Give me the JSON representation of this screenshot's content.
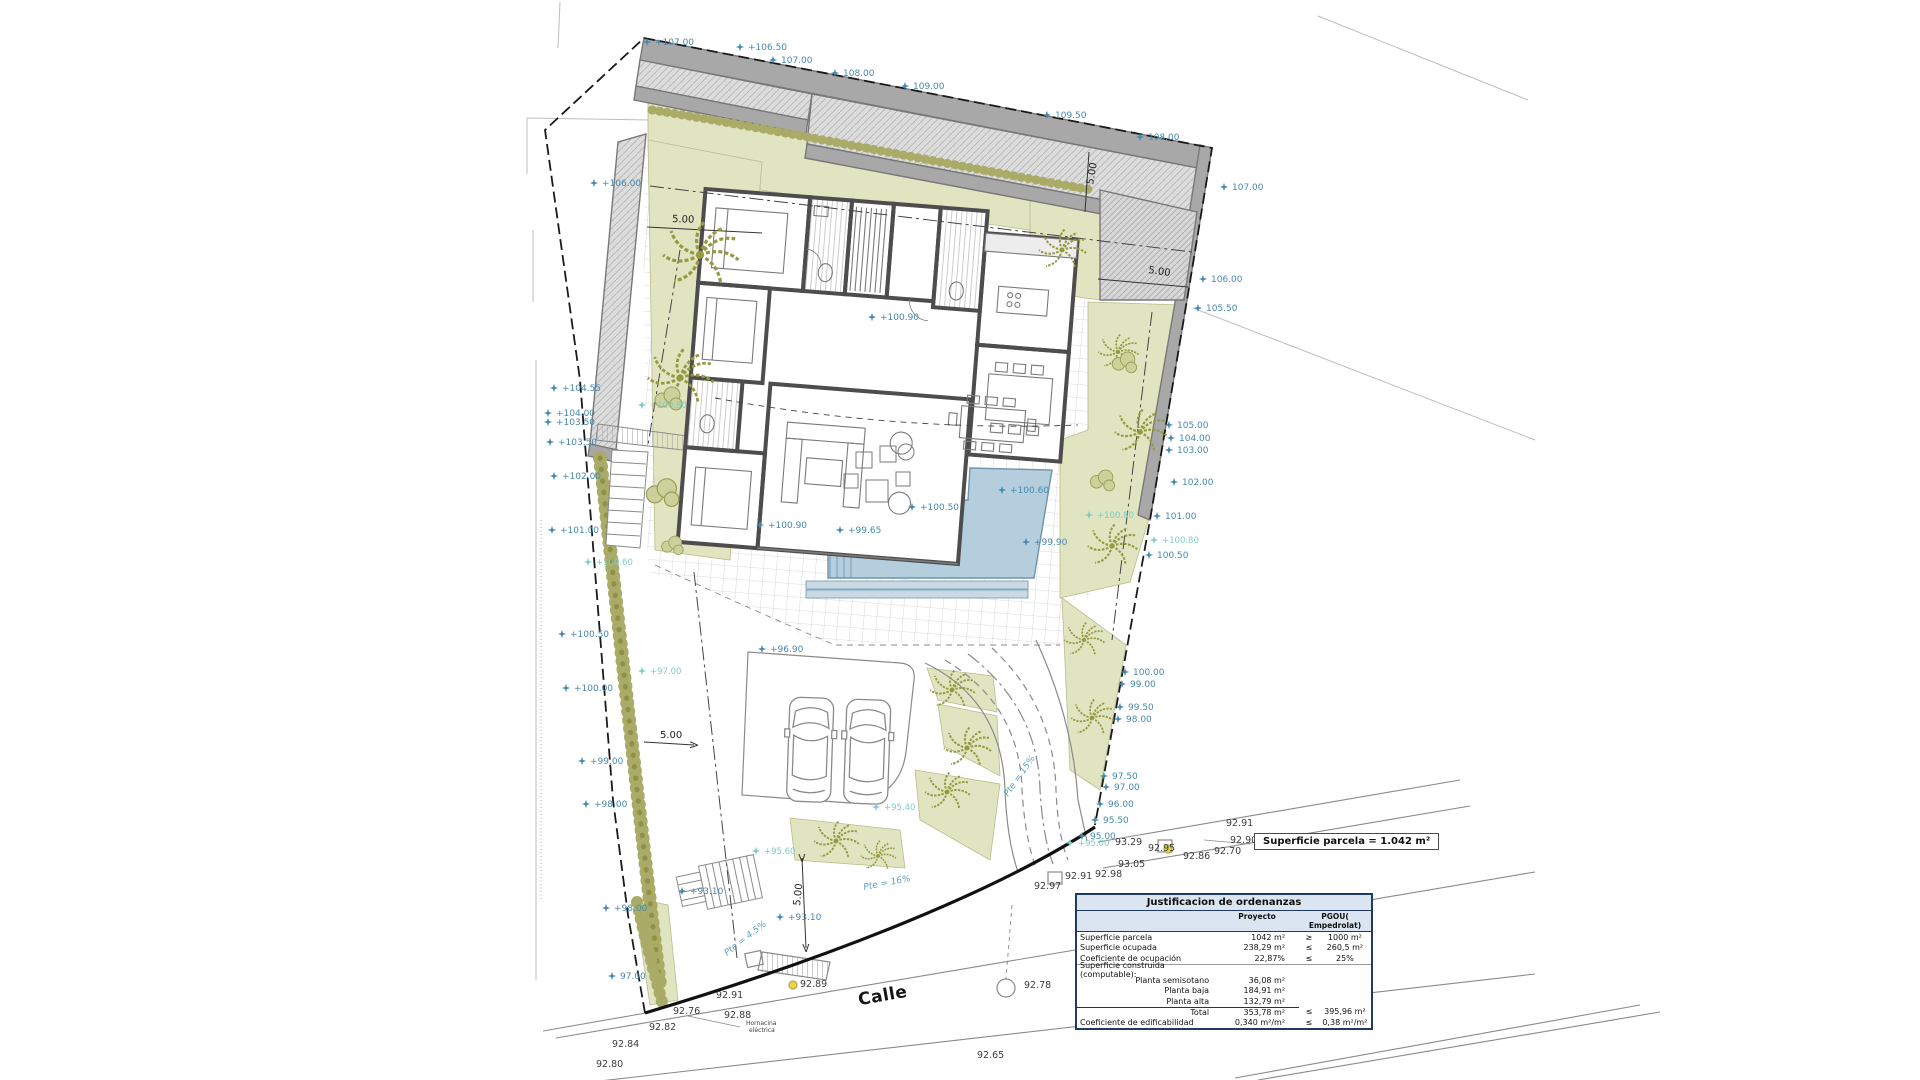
{
  "street": {
    "name": "Calle"
  },
  "parcel_box": {
    "text": "Superficie parcela = 1.042 m²"
  },
  "table": {
    "title": "Justificacion de ordenanzas",
    "col_proyecto": "Proyecto",
    "col_pgou": "PGOU( Empedrolat)",
    "rows": [
      {
        "label": "Superficie parcela",
        "proyecto": "1042 m²",
        "op": "≥",
        "pgou": "1000 m²",
        "style": "main"
      },
      {
        "label": "Superficie ocupada",
        "proyecto": "238,29 m²",
        "op": "≤",
        "pgou": "260,5 m²",
        "style": "main"
      },
      {
        "label": "Coeficiente de ocupación",
        "proyecto": "22,87%",
        "op": "≤",
        "pgou": "25%",
        "style": "main divider"
      },
      {
        "label": "Superficie construida (computable):",
        "proyecto": "",
        "op": "",
        "pgou": "",
        "style": "main"
      },
      {
        "label": "Planta semisotano",
        "proyecto": "36,08 m²",
        "op": "",
        "pgou": "",
        "style": "sub"
      },
      {
        "label": "Planta baja",
        "proyecto": "184,91 m²",
        "op": "",
        "pgou": "",
        "style": "sub"
      },
      {
        "label": "Planta alta",
        "proyecto": "132,79 m²",
        "op": "",
        "pgou": "",
        "style": "sub"
      },
      {
        "label": "Total",
        "proyecto": "353,78 m²",
        "op": "≤",
        "pgou": "395,96 m²",
        "style": "sub totalrow"
      },
      {
        "label": "Coeficiente de edificabilidad",
        "proyecto": "0,340 m²/m²",
        "op": "≤",
        "pgou": "0,38 m²/m²",
        "style": "main"
      }
    ]
  },
  "dims": [
    [
      672,
      222,
      "5.00",
      2
    ],
    [
      1148,
      273,
      "5.00",
      8
    ],
    [
      1093,
      185,
      "5.00",
      -80
    ],
    [
      660,
      738,
      "5.00",
      0
    ],
    [
      800,
      906,
      "5.00",
      -84
    ]
  ],
  "slopes": [
    [
      1008,
      797,
      "Pte = 15%",
      -55
    ],
    [
      864,
      890,
      "Pte = 16%",
      -11
    ],
    [
      727,
      956,
      "Pte = 4.5%",
      -38
    ]
  ],
  "levels_blue": [
    [
      655,
      45,
      "+107.00"
    ],
    [
      748,
      50,
      "+106.50"
    ],
    [
      781,
      63,
      "107.00"
    ],
    [
      843,
      76,
      "108.00"
    ],
    [
      913,
      89,
      "109.00"
    ],
    [
      1055,
      118,
      "109.50"
    ],
    [
      1148,
      140,
      "108.00"
    ],
    [
      1232,
      190,
      "107.00"
    ],
    [
      1211,
      282,
      "106.00"
    ],
    [
      1206,
      311,
      "105.50"
    ],
    [
      1177,
      428,
      "105.00"
    ],
    [
      1179,
      441,
      "104.00"
    ],
    [
      1177,
      453,
      "103.00"
    ],
    [
      1182,
      485,
      "102.00"
    ],
    [
      1165,
      519,
      "101.00"
    ],
    [
      1157,
      558,
      "100.50"
    ],
    [
      1133,
      675,
      "100.00"
    ],
    [
      1130,
      687,
      "99.00"
    ],
    [
      1128,
      710,
      "99.50"
    ],
    [
      1126,
      722,
      "98.00"
    ],
    [
      1112,
      779,
      "97.50"
    ],
    [
      1114,
      790,
      "97.00"
    ],
    [
      1108,
      807,
      "96.00"
    ],
    [
      1103,
      823,
      "95.50"
    ],
    [
      1090,
      839,
      "95.00"
    ],
    [
      562,
      391,
      "+104.55"
    ],
    [
      556,
      416,
      "+104.00"
    ],
    [
      556,
      425,
      "+103.50"
    ],
    [
      558,
      445,
      "+103.50"
    ],
    [
      562,
      479,
      "+102.00"
    ],
    [
      560,
      533,
      "+101.00"
    ],
    [
      570,
      637,
      "+100.50"
    ],
    [
      574,
      691,
      "+100.00"
    ],
    [
      590,
      764,
      "+99.00"
    ],
    [
      594,
      807,
      "+98.00"
    ],
    [
      614,
      911,
      "+98.00"
    ],
    [
      620,
      979,
      "97.00"
    ],
    [
      602,
      186,
      "+106.00"
    ],
    [
      1010,
      493,
      "+100.60"
    ],
    [
      920,
      510,
      "+100.50"
    ],
    [
      848,
      533,
      "+99.65"
    ],
    [
      1034,
      545,
      "+99.90"
    ],
    [
      880,
      320,
      "+100.90"
    ],
    [
      768,
      528,
      "+100.90"
    ],
    [
      770,
      652,
      "+96.90"
    ],
    [
      690,
      894,
      "+93.10"
    ],
    [
      788,
      920,
      "+93.10"
    ]
  ],
  "levels_teal": [
    [
      650,
      408,
      "+100.80"
    ],
    [
      1162,
      543,
      "+100.80"
    ],
    [
      1097,
      518,
      "+100.80"
    ],
    [
      596,
      565,
      "+100.60"
    ],
    [
      650,
      674,
      "+97.00"
    ],
    [
      764,
      854,
      "+95.60"
    ],
    [
      884,
      810,
      "+95.40"
    ],
    [
      1078,
      846,
      "+95.00"
    ]
  ],
  "levels_black": [
    [
      649,
      1030,
      "92.82"
    ],
    [
      673,
      1014,
      "92.76"
    ],
    [
      724,
      1018,
      "92.88"
    ],
    [
      716,
      998,
      "92.91"
    ],
    [
      1024,
      988,
      "92.78"
    ],
    [
      977,
      1058,
      "92.65"
    ],
    [
      1152,
      1026,
      "92.63"
    ],
    [
      596,
      1067,
      "92.80"
    ],
    [
      612,
      1047,
      "92.84"
    ],
    [
      1115,
      845,
      "93.29"
    ],
    [
      1148,
      851,
      "92.95"
    ],
    [
      1118,
      867,
      "93.05"
    ],
    [
      1095,
      877,
      "92.98"
    ],
    [
      1065,
      879,
      "92.91"
    ],
    [
      1034,
      889,
      "92.97"
    ],
    [
      1183,
      859,
      "92.86"
    ],
    [
      1214,
      854,
      "92.70"
    ],
    [
      1230,
      843,
      "92.90"
    ],
    [
      1226,
      826,
      "92.91"
    ],
    [
      800,
      987,
      "92.89"
    ]
  ],
  "notes": [
    [
      746,
      1025,
      "Hornacina"
    ],
    [
      749,
      1032,
      "eléctrica"
    ]
  ],
  "palms": [
    [
      700,
      255,
      1.6
    ],
    [
      680,
      378,
      1.4
    ],
    [
      1062,
      250,
      1.0
    ],
    [
      1140,
      432,
      1.1
    ],
    [
      1118,
      352,
      0.85
    ],
    [
      1112,
      546,
      1.05
    ],
    [
      1084,
      640,
      0.85
    ],
    [
      1092,
      718,
      0.9
    ],
    [
      952,
      690,
      0.95
    ],
    [
      967,
      748,
      1.0
    ],
    [
      947,
      792,
      0.95
    ],
    [
      836,
      841,
      0.95
    ],
    [
      878,
      856,
      0.75
    ]
  ],
  "bushes": [
    [
      668,
      398,
      1.0
    ],
    [
      662,
      492,
      1.2
    ],
    [
      1102,
      480,
      0.9
    ],
    [
      672,
      545,
      0.8
    ],
    [
      1124,
      362,
      0.9
    ]
  ]
}
